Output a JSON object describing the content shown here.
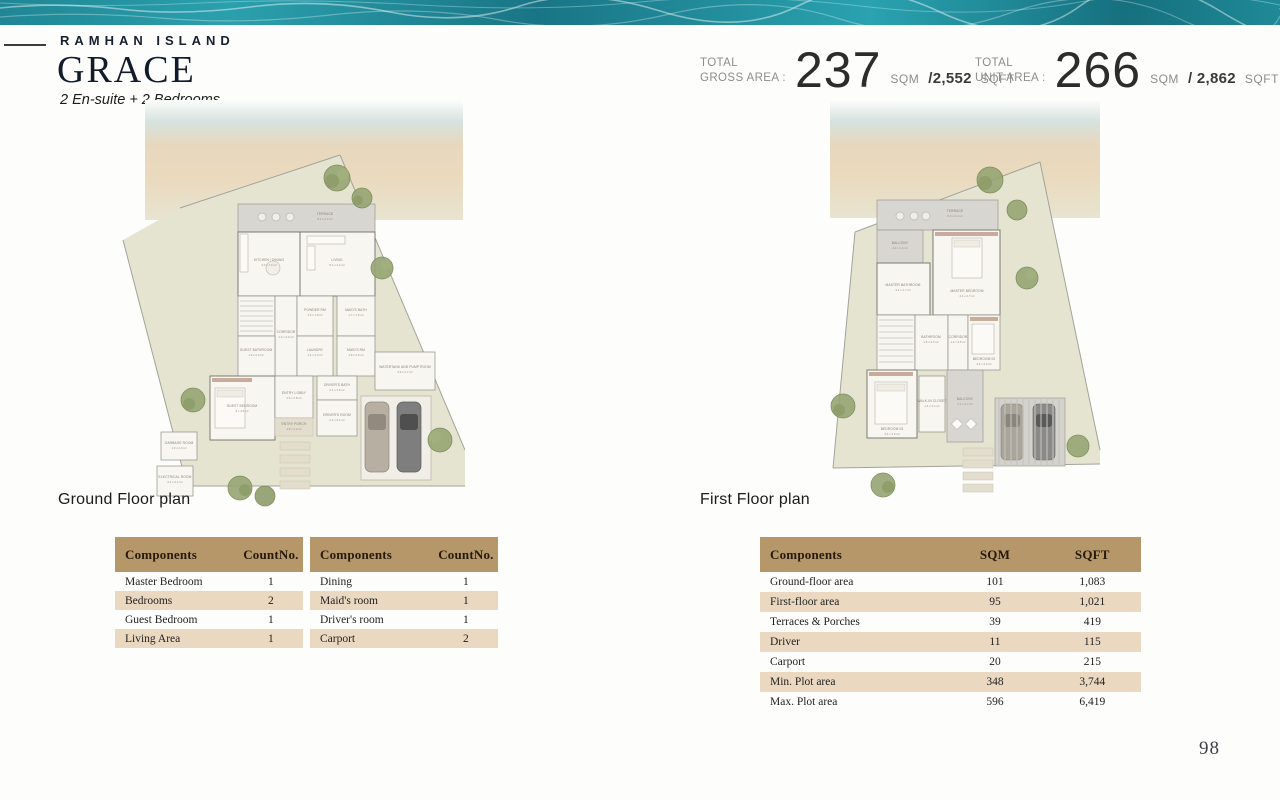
{
  "header": {
    "brand": "RAMHAN ISLAND",
    "title": "GRACE",
    "subtitle": "2 En-suite + 2 Bedrooms"
  },
  "stats": {
    "gross": {
      "l1": "TOTAL",
      "l2": "GROSS AREA :",
      "value": "237",
      "unit": "SQM",
      "sqft": "/2,552",
      "sqft_unit": "SQFT"
    },
    "unit": {
      "l1": "TOTAL",
      "l2": "UNIT AREA :",
      "value": "266",
      "unit": "SQM",
      "sqft": "/ 2,862",
      "sqft_unit": "SQFT"
    }
  },
  "plans": {
    "ground": {
      "caption": "Ground Floor plan",
      "rooms": [
        {
          "name": "TERRACE",
          "dims": "8.2 x 2.2 m²"
        },
        {
          "name": "KITCHEN / DINING",
          "dims": "3.0 x 7.4 m²"
        },
        {
          "name": "LIVING",
          "dims": "5.1 x 4.2 m²"
        },
        {
          "name": "CORRIDOR",
          "dims": "1.2 x 4.4 m²"
        },
        {
          "name": "POWDER RM",
          "dims": "1.6 x 1.8 m²"
        },
        {
          "name": "MAID'S BATH",
          "dims": "1.7 x 1.5 m²"
        },
        {
          "name": "GUEST BATHROOM",
          "dims": "1.9 x 2.4 m²"
        },
        {
          "name": "LAUNDRY",
          "dims": "1.4 x 3.0 m²"
        },
        {
          "name": "MAID'S RM",
          "dims": "1.9 x 2.3 m²"
        },
        {
          "name": "GUEST BEDROOM",
          "dims": "3 x 4.5 m²"
        },
        {
          "name": "ENTRY LOBBY",
          "dims": "1.6 x 2.8 m²"
        },
        {
          "name": "DRIVER'S BATH",
          "dims": "2.1 x 1.6 m²"
        },
        {
          "name": "DRIVER'S ROOM",
          "dims": "2.1 x 3.1 m²"
        },
        {
          "name": "ENTRY PORCH",
          "dims": "1.9 x 1.2 m²"
        },
        {
          "name": "WATERTANK AND PUMP ROOM",
          "dims": "3.9 x 2.7 m²"
        },
        {
          "name": "GARBAGE ROOM",
          "dims": "1.9 x 2.0 m²"
        },
        {
          "name": "ELECTRICAL ROOM",
          "dims": "2.2 x 2.1 m²"
        }
      ]
    },
    "first": {
      "caption": "First Floor plan",
      "rooms": [
        {
          "name": "TERRACE",
          "dims": "8.2 x 2.2 m²"
        },
        {
          "name": "BALCONY",
          "dims": "2.2 x 1.4 m²"
        },
        {
          "name": "MASTER BEDROOM",
          "dims": "4.4 x 4.7 m²"
        },
        {
          "name": "MASTER BATHROOM",
          "dims": "3.4 x 1.7 m²"
        },
        {
          "name": "BATHROOM",
          "dims": "1.6 x 3.0 m²"
        },
        {
          "name": "CORRIDOR",
          "dims": "1.2 x 3.5 m²"
        },
        {
          "name": "BEDROOM 02",
          "dims": "3.4 x 3.0 m²"
        },
        {
          "name": "BEDROOM 03",
          "dims": "3.4 x 4.6 m²"
        },
        {
          "name": "WALK-IN CLOSET",
          "dims": "1.4 x 3.4 m²"
        },
        {
          "name": "BALCONY",
          "dims": "2.2 x 4.7 m²"
        }
      ]
    }
  },
  "tables": {
    "count1": {
      "headers": [
        "Components",
        "CountNo."
      ],
      "rows": [
        [
          "Master Bedroom",
          "1"
        ],
        [
          "Bedrooms",
          "2"
        ],
        [
          "Guest Bedroom",
          "1"
        ],
        [
          "Living Area",
          "1"
        ]
      ]
    },
    "count2": {
      "headers": [
        "Components",
        "CountNo."
      ],
      "rows": [
        [
          "Dining",
          "1"
        ],
        [
          "Maid's room",
          "1"
        ],
        [
          "Driver's room",
          "1"
        ],
        [
          "Carport",
          "2"
        ]
      ]
    },
    "areas": {
      "headers": [
        "Components",
        "SQM",
        "SQFT"
      ],
      "rows": [
        [
          "Ground-floor area",
          "101",
          "1,083"
        ],
        [
          "First-floor area",
          "95",
          "1,021"
        ],
        [
          "Terraces & Porches",
          "39",
          "419"
        ],
        [
          "Driver",
          "11",
          "115"
        ],
        [
          "Carport",
          "20",
          "215"
        ],
        [
          "Min. Plot area",
          "348",
          "3,744"
        ],
        [
          "Max. Plot area",
          "596",
          "6,419"
        ]
      ]
    }
  },
  "page_number": "98",
  "colors": {
    "table_header": "#b5976a",
    "table_stripe": "#ead9c0",
    "water_teal": "#2191a0",
    "plot_green": "#e4e4d1"
  }
}
